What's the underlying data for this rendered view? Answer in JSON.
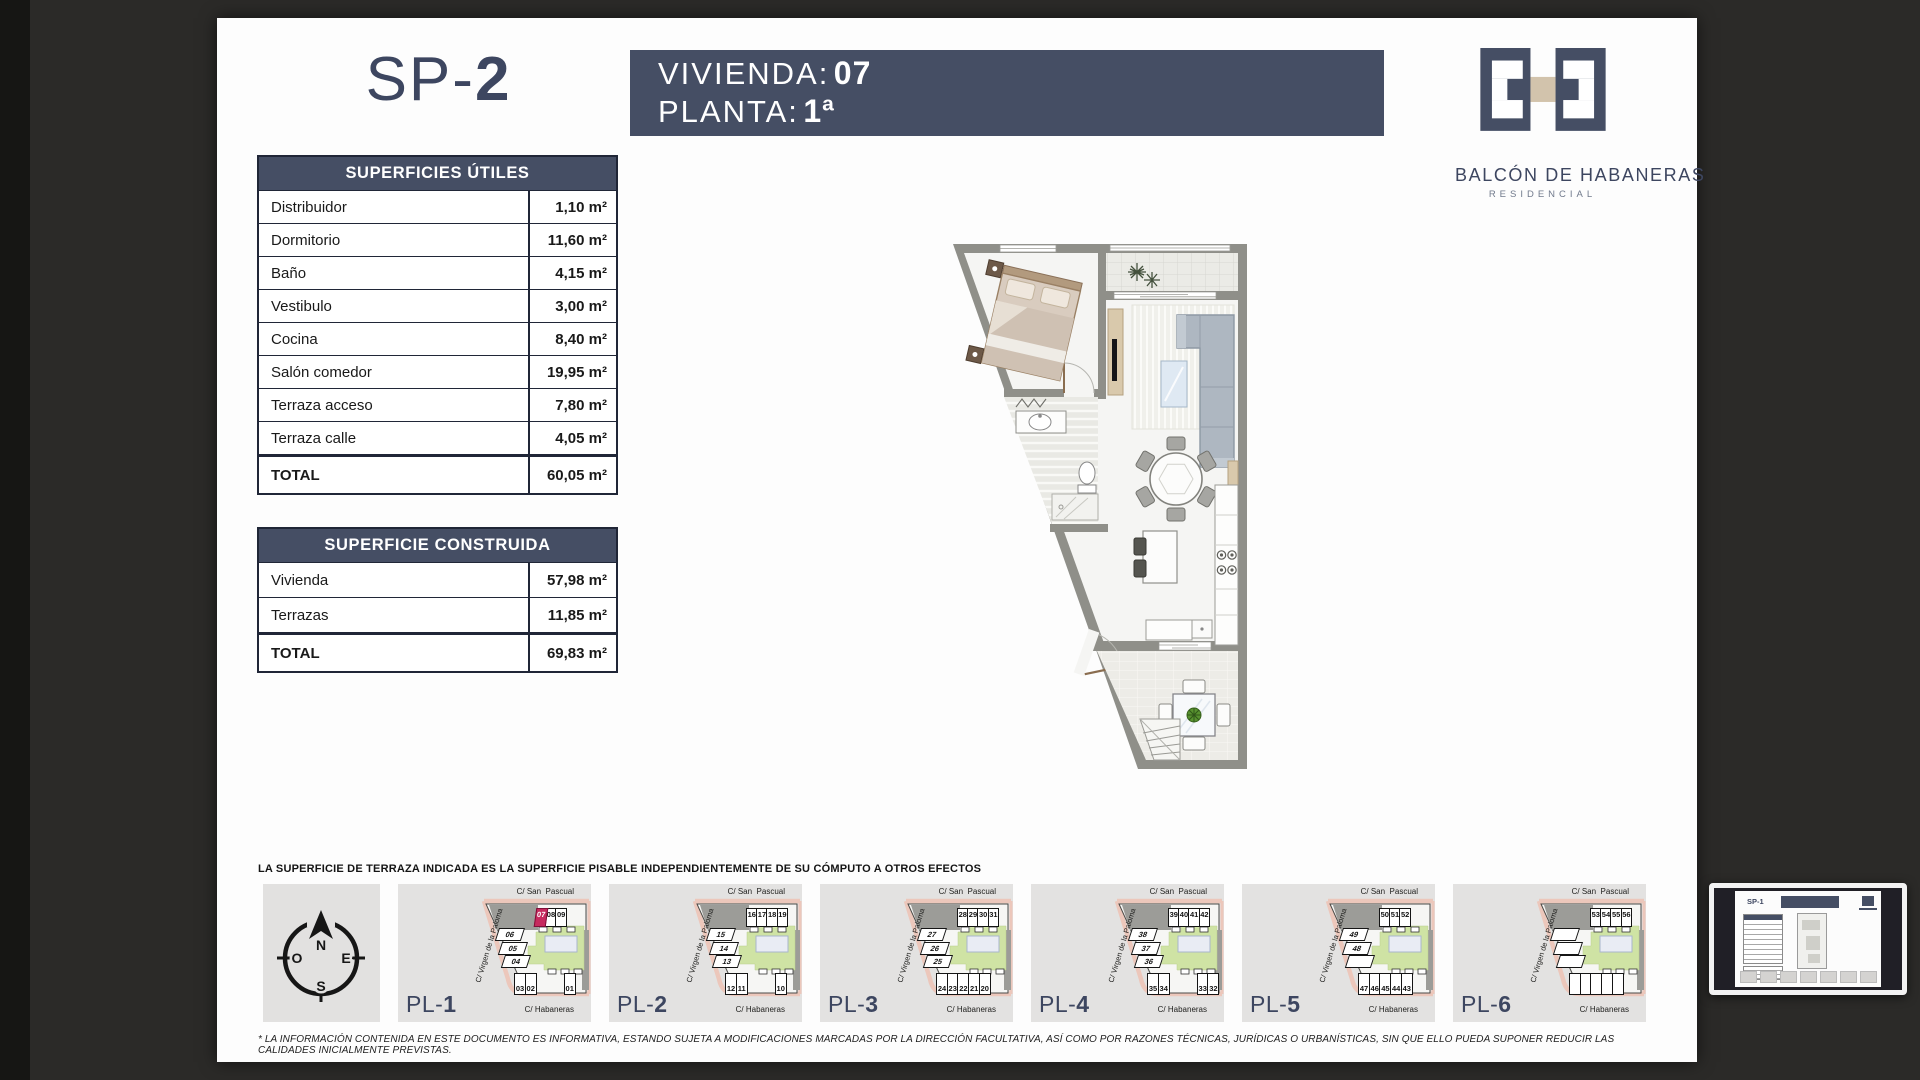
{
  "sheet": {
    "code_prefix": "SP-",
    "code_num": "2"
  },
  "header": {
    "vivienda_label": "VIVIENDA:",
    "vivienda_value": "07",
    "planta_label": "PLANTA:",
    "planta_value": "1ª"
  },
  "brand": {
    "name": "BALCÓN DE HABANERAS",
    "subtitle": "RESIDENCIAL"
  },
  "tables": {
    "utiles": {
      "title": "SUPERFICIES ÚTILES",
      "rows": [
        {
          "label": "Distribuidor",
          "value": "1,10 m²"
        },
        {
          "label": "Dormitorio",
          "value": "11,60 m²"
        },
        {
          "label": "Baño",
          "value": "4,15 m²"
        },
        {
          "label": "Vestibulo",
          "value": "3,00 m²"
        },
        {
          "label": "Cocina",
          "value": "8,40 m²"
        },
        {
          "label": "Salón comedor",
          "value": "19,95 m²"
        },
        {
          "label": "Terraza acceso",
          "value": "7,80 m²"
        },
        {
          "label": "Terraza calle",
          "value": "4,05 m²"
        }
      ],
      "total": {
        "label": "TOTAL",
        "value": "60,05 m²"
      }
    },
    "construida": {
      "title": "SUPERFICIE CONSTRUIDA",
      "rows": [
        {
          "label": "Vivienda",
          "value": "57,98 m²"
        },
        {
          "label": "Terrazas",
          "value": "11,85 m²"
        }
      ],
      "total": {
        "label": "TOTAL",
        "value": "69,83 m²"
      }
    }
  },
  "note": "LA SUPERFICIE DE TERRAZA INDICADA ES LA SUPERFICIE PISABLE INDEPENDIENTEMENTE DE SU CÓMPUTO A OTROS EFECTOS",
  "disclaimer": "* LA INFORMACIÓN CONTENIDA EN ESTE DOCUMENTO ES INFORMATIVA, ESTANDO SUJETA A MODIFICACIONES MARCADAS POR LA DIRECCIÓN FACULTATIVA, ASÍ COMO POR RAZONES TÉCNICAS, JURÍDICAS O URBANÍSTICAS, SIN QUE ELLO PUEDA SUPONER REDUCIR LAS CALIDADES INICIALMENTE PREVISTAS.",
  "compass": {
    "n": "N",
    "s": "S",
    "e": "E",
    "o": "O"
  },
  "strip": {
    "streets": {
      "top": "C/ San  Pascual",
      "left": "C/ Virgen de la Paloma",
      "bottom": "C/ Habaneras"
    },
    "plans": [
      {
        "prefix": "PL-",
        "num": "1",
        "top_units": [
          {
            "n": "07",
            "hl": true
          },
          {
            "n": "08"
          },
          {
            "n": "09"
          }
        ],
        "diag_units": [
          {
            "n": "06"
          },
          {
            "n": "05"
          },
          {
            "n": "04"
          }
        ],
        "bottom_units": [
          {
            "n": "03"
          },
          {
            "n": "02"
          },
          {
            "n": "01",
            "gap": true
          }
        ]
      },
      {
        "prefix": "PL-",
        "num": "2",
        "top_units": [
          {
            "n": "16"
          },
          {
            "n": "17"
          },
          {
            "n": "18"
          },
          {
            "n": "19"
          }
        ],
        "diag_units": [
          {
            "n": "15"
          },
          {
            "n": "14"
          },
          {
            "n": "13"
          }
        ],
        "bottom_units": [
          {
            "n": "12"
          },
          {
            "n": "11"
          },
          {
            "n": "10",
            "gap": true
          }
        ]
      },
      {
        "prefix": "PL-",
        "num": "3",
        "top_units": [
          {
            "n": "28"
          },
          {
            "n": "29"
          },
          {
            "n": "30"
          },
          {
            "n": "31"
          }
        ],
        "diag_units": [
          {
            "n": "27"
          },
          {
            "n": "26"
          },
          {
            "n": "25"
          }
        ],
        "bottom_units": [
          {
            "n": "24"
          },
          {
            "n": "23"
          },
          {
            "n": "22"
          },
          {
            "n": "21"
          },
          {
            "n": "20"
          }
        ]
      },
      {
        "prefix": "PL-",
        "num": "4",
        "top_units": [
          {
            "n": "39"
          },
          {
            "n": "40"
          },
          {
            "n": "41"
          },
          {
            "n": "42"
          }
        ],
        "diag_units": [
          {
            "n": "38"
          },
          {
            "n": "37"
          },
          {
            "n": "36"
          }
        ],
        "bottom_units": [
          {
            "n": "35"
          },
          {
            "n": "34"
          },
          {
            "n": "33",
            "gap": true
          },
          {
            "n": "32"
          }
        ]
      },
      {
        "prefix": "PL-",
        "num": "5",
        "top_units": [
          {
            "n": "50"
          },
          {
            "n": "51"
          },
          {
            "n": "52"
          }
        ],
        "diag_units": [
          {
            "n": "49"
          },
          {
            "n": "48"
          },
          {
            "n": ""
          }
        ],
        "bottom_units": [
          {
            "n": "47"
          },
          {
            "n": "46"
          },
          {
            "n": "45"
          },
          {
            "n": "44"
          },
          {
            "n": "43"
          }
        ]
      },
      {
        "prefix": "PL-",
        "num": "6",
        "top_units": [
          {
            "n": "53"
          },
          {
            "n": "54"
          },
          {
            "n": "55"
          },
          {
            "n": "56"
          }
        ],
        "diag_units": [
          {
            "n": ""
          },
          {
            "n": ""
          },
          {
            "n": ""
          }
        ],
        "bottom_units": [
          {
            "n": ""
          },
          {
            "n": ""
          },
          {
            "n": ""
          },
          {
            "n": ""
          },
          {
            "n": ""
          }
        ]
      }
    ]
  },
  "thumbnail": {
    "title": "SP-1"
  }
}
